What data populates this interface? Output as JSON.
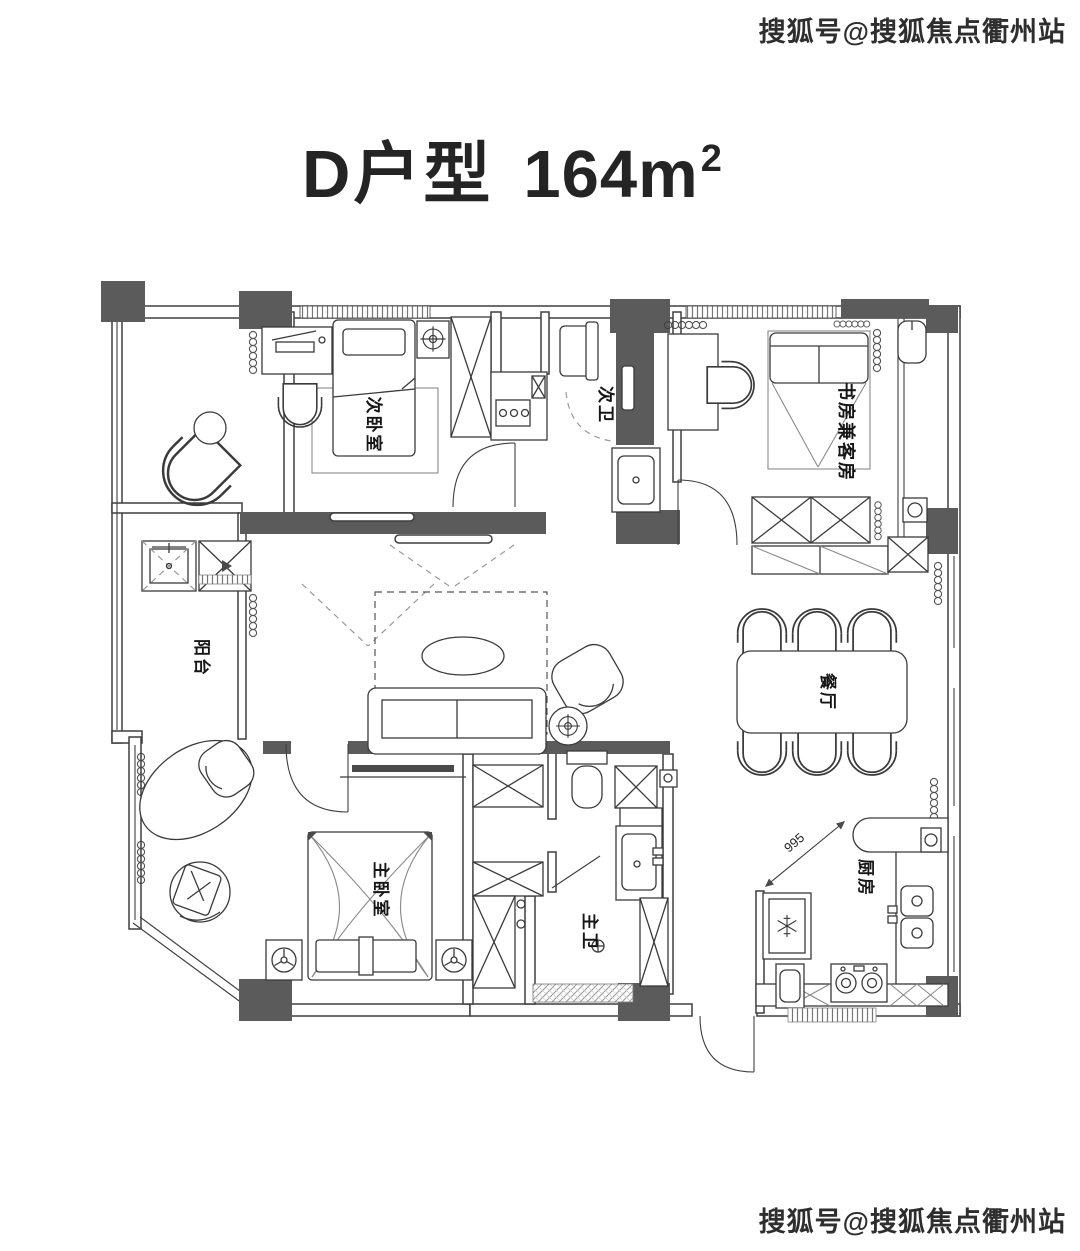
{
  "watermark": {
    "top": "搜狐号@搜狐焦点衢州站",
    "bottom": "搜狐号@搜狐焦点衢州站"
  },
  "title": {
    "name": "D户型",
    "area": "164m",
    "area_sup": "2"
  },
  "rooms": {
    "secondary_bedroom": "次卧室",
    "secondary_bath": "次卫",
    "study_guest": "书房兼客房",
    "balcony": "阳台",
    "dining": "餐厅",
    "master_bedroom": "主卧室",
    "master_bath": "主卫",
    "kitchen": "厨房"
  },
  "dims": {
    "kitchen_opening": "995"
  },
  "colors": {
    "wall_dark": "#5b5b5b",
    "line": "#3a3a3a",
    "background": "#ffffff",
    "text": "#161616"
  }
}
